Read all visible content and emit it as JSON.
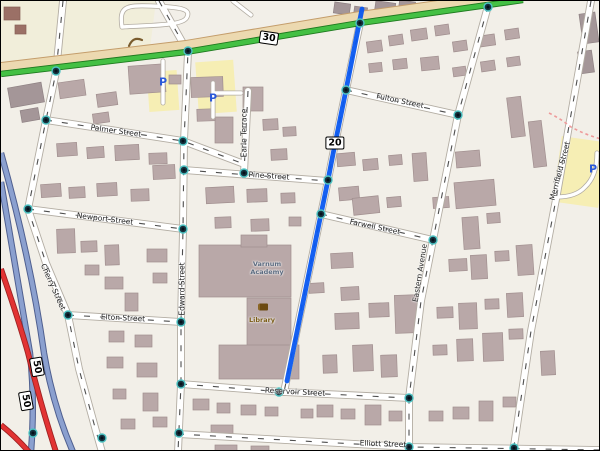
{
  "map": {
    "width": 600,
    "height": 451,
    "colors": {
      "land": "#f2efe8",
      "retail": "#f1eeda",
      "parking": "#f6eeb4",
      "building": [
        "#b9a8a8",
        "#a49698",
        "#9b7066"
      ],
      "building_border": [
        "#a18f8f",
        "#8f8284",
        "#865f56"
      ],
      "road_fill": "#ffffff",
      "road_casing": "#b3ada3",
      "road_dash": "#2f2f2f",
      "trunk_green": "#44c044",
      "trunk_casing": "#1f7a1f",
      "frontage_tan": "#ecd9b0",
      "frontage_casing": "#c49d6b",
      "motorway_blue": "#8ba0cf",
      "motorway_casing": "#4f5f8f",
      "primary_red": "#e23333",
      "primary_casing": "#9e2222",
      "route_highlight": "#0857f0",
      "footpath_pink": "#ee9a9a",
      "signal_ring": "#4cc3c3",
      "signal_core": "#16323e",
      "parking_p": "#2b59d8",
      "library_text": "#7a5c16",
      "academy_text": "#5b6b80",
      "hedge": "#7a5c2e"
    },
    "landuse": [
      {
        "name": "retail-block",
        "type": "poly",
        "pts": "0,0 155,0 148,55 0,76",
        "fill": "retail"
      },
      {
        "name": "parking-lot-a",
        "type": "rect",
        "x": 147,
        "y": 70,
        "w": 30,
        "h": 40,
        "r": -4,
        "fill": "parking"
      },
      {
        "name": "parking-lot-b",
        "type": "rect",
        "x": 196,
        "y": 60,
        "w": 38,
        "h": 52,
        "r": -4,
        "fill": "parking"
      },
      {
        "name": "parking-lot-merrifield",
        "type": "rect",
        "x": 556,
        "y": 138,
        "w": 46,
        "h": 66,
        "r": 8,
        "fill": "parking"
      }
    ],
    "buildings": [
      [
        333,
        2,
        16,
        11,
        8,
        1
      ],
      [
        353,
        6,
        13,
        9,
        8,
        1
      ],
      [
        374,
        1,
        20,
        12,
        8,
        1
      ],
      [
        398,
        0,
        16,
        9,
        8,
        1
      ],
      [
        430,
        0,
        15,
        9,
        5,
        1
      ],
      [
        452,
        1,
        13,
        8,
        5,
        1
      ],
      [
        580,
        12,
        16,
        30,
        -8,
        1
      ],
      [
        578,
        50,
        14,
        22,
        -8,
        1
      ],
      [
        3,
        6,
        16,
        13,
        0,
        2
      ],
      [
        14,
        24,
        11,
        9,
        0,
        2
      ],
      [
        8,
        84,
        34,
        20,
        -10,
        1
      ],
      [
        58,
        80,
        26,
        16,
        -8,
        0
      ],
      [
        96,
        92,
        20,
        13,
        -8,
        0
      ],
      [
        128,
        64,
        36,
        28,
        -4,
        0
      ],
      [
        92,
        112,
        16,
        10,
        -8,
        0
      ],
      [
        20,
        108,
        18,
        12,
        -10,
        1
      ],
      [
        168,
        74,
        12,
        9,
        0,
        0
      ],
      [
        190,
        76,
        32,
        20,
        -2,
        0
      ],
      [
        214,
        116,
        18,
        26,
        0,
        0
      ],
      [
        242,
        86,
        20,
        24,
        0,
        0
      ],
      [
        262,
        118,
        15,
        11,
        -3,
        0
      ],
      [
        282,
        126,
        13,
        9,
        -3,
        0
      ],
      [
        270,
        148,
        16,
        11,
        -3,
        0
      ],
      [
        56,
        142,
        20,
        13,
        -4,
        0
      ],
      [
        86,
        146,
        17,
        11,
        -4,
        0
      ],
      [
        114,
        144,
        24,
        15,
        -3,
        0
      ],
      [
        148,
        152,
        18,
        11,
        -2,
        0
      ],
      [
        40,
        183,
        20,
        13,
        -4,
        0
      ],
      [
        68,
        186,
        16,
        11,
        -3,
        0
      ],
      [
        96,
        182,
        20,
        13,
        -3,
        0
      ],
      [
        130,
        188,
        18,
        12,
        -2,
        0
      ],
      [
        152,
        164,
        22,
        14,
        -3,
        0
      ],
      [
        56,
        228,
        18,
        24,
        -2,
        0
      ],
      [
        80,
        240,
        16,
        11,
        -2,
        0
      ],
      [
        104,
        244,
        14,
        20,
        -2,
        0
      ],
      [
        84,
        264,
        14,
        10,
        0,
        0
      ],
      [
        104,
        276,
        18,
        12,
        0,
        0
      ],
      [
        124,
        292,
        13,
        18,
        0,
        0
      ],
      [
        146,
        248,
        20,
        13,
        0,
        0
      ],
      [
        152,
        272,
        14,
        10,
        0,
        0
      ],
      [
        108,
        330,
        15,
        11,
        0,
        0
      ],
      [
        134,
        334,
        17,
        12,
        0,
        0
      ],
      [
        106,
        356,
        16,
        11,
        0,
        0
      ],
      [
        136,
        362,
        20,
        14,
        0,
        0
      ],
      [
        112,
        388,
        13,
        10,
        0,
        0
      ],
      [
        142,
        392,
        15,
        18,
        0,
        0
      ],
      [
        152,
        416,
        14,
        10,
        0,
        0
      ],
      [
        120,
        418,
        14,
        10,
        0,
        0
      ],
      [
        205,
        186,
        28,
        16,
        -3,
        0
      ],
      [
        246,
        188,
        20,
        13,
        -2,
        0
      ],
      [
        280,
        192,
        14,
        10,
        -2,
        0
      ],
      [
        214,
        216,
        16,
        11,
        -2,
        0
      ],
      [
        250,
        218,
        18,
        12,
        -2,
        0
      ],
      [
        288,
        216,
        12,
        9,
        0,
        0
      ],
      [
        196,
        108,
        18,
        12,
        -2,
        0
      ],
      [
        198,
        244,
        92,
        52,
        0,
        0
      ],
      [
        240,
        234,
        26,
        12,
        0,
        0
      ],
      [
        246,
        297,
        44,
        50,
        0,
        0
      ],
      [
        218,
        344,
        80,
        34,
        0,
        0
      ],
      [
        366,
        40,
        15,
        11,
        -8,
        0
      ],
      [
        388,
        34,
        14,
        10,
        -8,
        0
      ],
      [
        410,
        28,
        16,
        11,
        -8,
        0
      ],
      [
        434,
        24,
        14,
        10,
        -8,
        0
      ],
      [
        368,
        62,
        13,
        9,
        -6,
        0
      ],
      [
        392,
        58,
        14,
        10,
        -6,
        0
      ],
      [
        420,
        56,
        18,
        13,
        -6,
        0
      ],
      [
        336,
        152,
        18,
        13,
        -5,
        0
      ],
      [
        362,
        158,
        15,
        11,
        -5,
        0
      ],
      [
        388,
        154,
        13,
        10,
        -5,
        0
      ],
      [
        338,
        186,
        20,
        13,
        -5,
        0
      ],
      [
        352,
        196,
        26,
        17,
        -6,
        0
      ],
      [
        386,
        196,
        14,
        10,
        -5,
        0
      ],
      [
        412,
        152,
        14,
        28,
        -4,
        0
      ],
      [
        432,
        196,
        16,
        11,
        -4,
        0
      ],
      [
        330,
        252,
        22,
        15,
        -3,
        0
      ],
      [
        308,
        282,
        15,
        10,
        -3,
        0
      ],
      [
        340,
        286,
        18,
        13,
        -3,
        0
      ],
      [
        334,
        312,
        24,
        16,
        -2,
        0
      ],
      [
        368,
        302,
        20,
        14,
        -2,
        0
      ],
      [
        394,
        294,
        24,
        38,
        -2,
        0
      ],
      [
        352,
        344,
        20,
        26,
        -2,
        0
      ],
      [
        380,
        354,
        16,
        22,
        -2,
        0
      ],
      [
        322,
        354,
        14,
        18,
        -2,
        0
      ],
      [
        316,
        404,
        16,
        12,
        0,
        0
      ],
      [
        340,
        408,
        14,
        10,
        0,
        0
      ],
      [
        364,
        404,
        16,
        20,
        0,
        0
      ],
      [
        388,
        410,
        13,
        10,
        0,
        0
      ],
      [
        300,
        408,
        12,
        9,
        0,
        0
      ],
      [
        192,
        398,
        16,
        11,
        0,
        0
      ],
      [
        216,
        402,
        13,
        10,
        0,
        0
      ],
      [
        240,
        404,
        15,
        10,
        0,
        0
      ],
      [
        264,
        406,
        13,
        9,
        0,
        0
      ],
      [
        210,
        424,
        22,
        10,
        0,
        0
      ],
      [
        214,
        444,
        22,
        6,
        0,
        0
      ],
      [
        250,
        445,
        18,
        6,
        0,
        0
      ],
      [
        452,
        40,
        14,
        10,
        -8,
        0
      ],
      [
        478,
        34,
        16,
        11,
        -8,
        0
      ],
      [
        504,
        28,
        14,
        10,
        -8,
        0
      ],
      [
        452,
        66,
        13,
        9,
        -8,
        0
      ],
      [
        480,
        60,
        14,
        10,
        -8,
        0
      ],
      [
        506,
        56,
        13,
        9,
        -8,
        0
      ],
      [
        508,
        96,
        14,
        40,
        -7,
        0
      ],
      [
        530,
        120,
        13,
        46,
        -7,
        0
      ],
      [
        455,
        150,
        24,
        16,
        -5,
        0
      ],
      [
        454,
        180,
        40,
        26,
        -5,
        0
      ],
      [
        462,
        216,
        16,
        32,
        -4,
        0
      ],
      [
        486,
        212,
        13,
        10,
        -4,
        0
      ],
      [
        516,
        244,
        16,
        30,
        -4,
        0
      ],
      [
        448,
        258,
        18,
        12,
        -3,
        0
      ],
      [
        470,
        254,
        16,
        24,
        -3,
        0
      ],
      [
        494,
        250,
        14,
        10,
        -3,
        0
      ],
      [
        436,
        306,
        16,
        11,
        -2,
        0
      ],
      [
        458,
        302,
        18,
        26,
        -2,
        0
      ],
      [
        484,
        298,
        14,
        10,
        -2,
        0
      ],
      [
        506,
        292,
        16,
        24,
        -3,
        0
      ],
      [
        432,
        344,
        14,
        10,
        -2,
        0
      ],
      [
        456,
        338,
        16,
        22,
        -2,
        0
      ],
      [
        482,
        332,
        20,
        28,
        -2,
        0
      ],
      [
        508,
        328,
        14,
        10,
        -2,
        0
      ],
      [
        540,
        350,
        14,
        24,
        -3,
        0
      ],
      [
        428,
        410,
        14,
        10,
        0,
        0
      ],
      [
        452,
        406,
        16,
        12,
        0,
        0
      ],
      [
        478,
        400,
        14,
        20,
        0,
        0
      ],
      [
        502,
        396,
        13,
        10,
        0,
        0
      ]
    ],
    "streets": [
      {
        "name": "cherry-street",
        "path": "M62,0 L55,71 L45,119 L27,208 L45,262 L67,314 L78,368 L95,430 L101,451"
      },
      {
        "name": "edward-street",
        "path": "M158,0 L187,51 L183,140 L182,228 L180,321 L180,383 L177,451"
      },
      {
        "name": "palmer-street",
        "path": "M45,119 L182,140 L243,163"
      },
      {
        "name": "earle-terrace",
        "path": "M247,90 L243,172"
      },
      {
        "name": "pine-street",
        "path": "M183,169 L327,180"
      },
      {
        "name": "newport-street",
        "path": "M27,208 L182,228"
      },
      {
        "name": "elton-street",
        "path": "M67,314 L180,321"
      },
      {
        "name": "reservoir-street",
        "path": "M180,383 L283,391 L408,397"
      },
      {
        "name": "elliott-street",
        "path": "M177,433 L408,446 L600,449"
      },
      {
        "name": "fulton-street",
        "path": "M345,89 L457,114"
      },
      {
        "name": "farwell-street",
        "path": "M320,213 L432,239"
      },
      {
        "name": "eastern-avenue",
        "path": "M487,5 L457,114 L432,239 L420,300 L408,397 L408,446"
      },
      {
        "name": "merrifield-street",
        "path": "M590,0 L556,193 L530,330 L513,445 L511,451"
      },
      {
        "name": "route-20-road",
        "path": "M359,22 L345,89 L333,148 L327,179 L320,213 L283,391"
      }
    ],
    "minor_roads": [
      {
        "name": "parking-loop-north",
        "path": "M121,26 C118,6 124,4 150,5 C180,6 190,8 186,16 C183,25 150,24 121,26"
      },
      {
        "name": "top-connector",
        "path": "M232,0 L250,14"
      },
      {
        "name": "parking-aisle-a",
        "path": "M162,60 L162,102"
      },
      {
        "name": "parking-aisle-b",
        "path": "M212,82 L212,116 M212,92 L240,92"
      },
      {
        "name": "merrifield-service",
        "path": "M556,196 Q575,196 584,186 Q596,175 596,152"
      }
    ],
    "major_roads": {
      "frontage": {
        "name": "route-30-frontage",
        "path": "M0,66 L185,44 L359,15 L522,-8"
      },
      "trunk": {
        "name": "route-30-trunk",
        "path": "M0,73 L185,51 L359,22 L522,-1"
      },
      "motorways": [
        {
          "name": "motorway-west",
          "path": "M0,181 Q20,300 29,352 Q34,400 30,451"
        },
        {
          "name": "motorway-east",
          "path": "M0,152 Q30,260 43,352 Q52,405 72,451"
        }
      ],
      "primaries": [
        {
          "name": "route-50-road",
          "path": "M0,268 Q18,320 27,352 Q40,405 55,451"
        },
        {
          "name": "route-50-ramp",
          "path": "M0,424 Q15,436 28,451"
        }
      ]
    },
    "route_highlight": {
      "name": "selected-route",
      "path": "M361,8 L345,89 L333,148 L327,179 L320,213 L286,380"
    },
    "footpath": {
      "name": "footpath",
      "path": "M548,112 Q560,118 570,126 Q585,134 600,138"
    },
    "hedge": {
      "name": "hedge-row",
      "path": "M128,45 Q132,35 141,39"
    },
    "signals": [
      [
        55,
        70
      ],
      [
        187,
        50
      ],
      [
        359,
        22
      ],
      [
        487,
        6
      ],
      [
        45,
        119
      ],
      [
        27,
        208
      ],
      [
        67,
        314
      ],
      [
        32,
        432
      ],
      [
        101,
        437
      ],
      [
        182,
        140
      ],
      [
        183,
        169
      ],
      [
        182,
        228
      ],
      [
        180,
        321
      ],
      [
        180,
        383
      ],
      [
        178,
        432
      ],
      [
        243,
        172
      ],
      [
        327,
        179
      ],
      [
        345,
        89
      ],
      [
        320,
        213
      ],
      [
        278,
        391
      ],
      [
        457,
        114
      ],
      [
        432,
        239
      ],
      [
        408,
        397
      ],
      [
        408,
        446
      ],
      [
        513,
        447
      ]
    ],
    "shields": [
      {
        "num": "30",
        "x": 268,
        "y": 37,
        "rot": 8
      },
      {
        "num": "20",
        "x": 334,
        "y": 142,
        "rot": 0
      },
      {
        "num": "50",
        "x": 36,
        "y": 366,
        "rot": 80
      },
      {
        "num": "50",
        "x": 25,
        "y": 400,
        "rot": 80
      }
    ],
    "street_labels": [
      {
        "text": "Palmer Street",
        "x": 115,
        "y": 130,
        "rot": 8
      },
      {
        "text": "Newport Street",
        "x": 104,
        "y": 218,
        "rot": 7
      },
      {
        "text": "Cherry Street",
        "x": 52,
        "y": 286,
        "rot": 66
      },
      {
        "text": "Elton Street",
        "x": 122,
        "y": 317,
        "rot": 3
      },
      {
        "text": "Edward Street",
        "x": 181,
        "y": 288,
        "rot": -90
      },
      {
        "text": "Earle Terrace",
        "x": 243,
        "y": 132,
        "rot": -90
      },
      {
        "text": "Pine Street",
        "x": 268,
        "y": 175,
        "rot": 4
      },
      {
        "text": "Fulton Street",
        "x": 399,
        "y": 100,
        "rot": 12
      },
      {
        "text": "Farwell Street",
        "x": 374,
        "y": 226,
        "rot": 12
      },
      {
        "text": "Eastern Avenue",
        "x": 419,
        "y": 272,
        "rot": -81
      },
      {
        "text": "Merrifield Street",
        "x": 559,
        "y": 170,
        "rot": -75
      },
      {
        "text": "Reservoir Street",
        "x": 294,
        "y": 391,
        "rot": 3
      },
      {
        "text": "Elliott Street",
        "x": 382,
        "y": 443,
        "rot": 2
      }
    ],
    "pois": {
      "library": {
        "label": "Library",
        "icon_x": 262,
        "icon_y": 306,
        "label_x": 261,
        "label_y": 320
      },
      "academy": {
        "label": "Varnum\nAcademy",
        "x": 266,
        "y": 268
      },
      "parking_icons": [
        {
          "x": 162,
          "y": 81
        },
        {
          "x": 212,
          "y": 97
        },
        {
          "x": 592,
          "y": 168
        }
      ],
      "parking_letter": "P"
    }
  }
}
